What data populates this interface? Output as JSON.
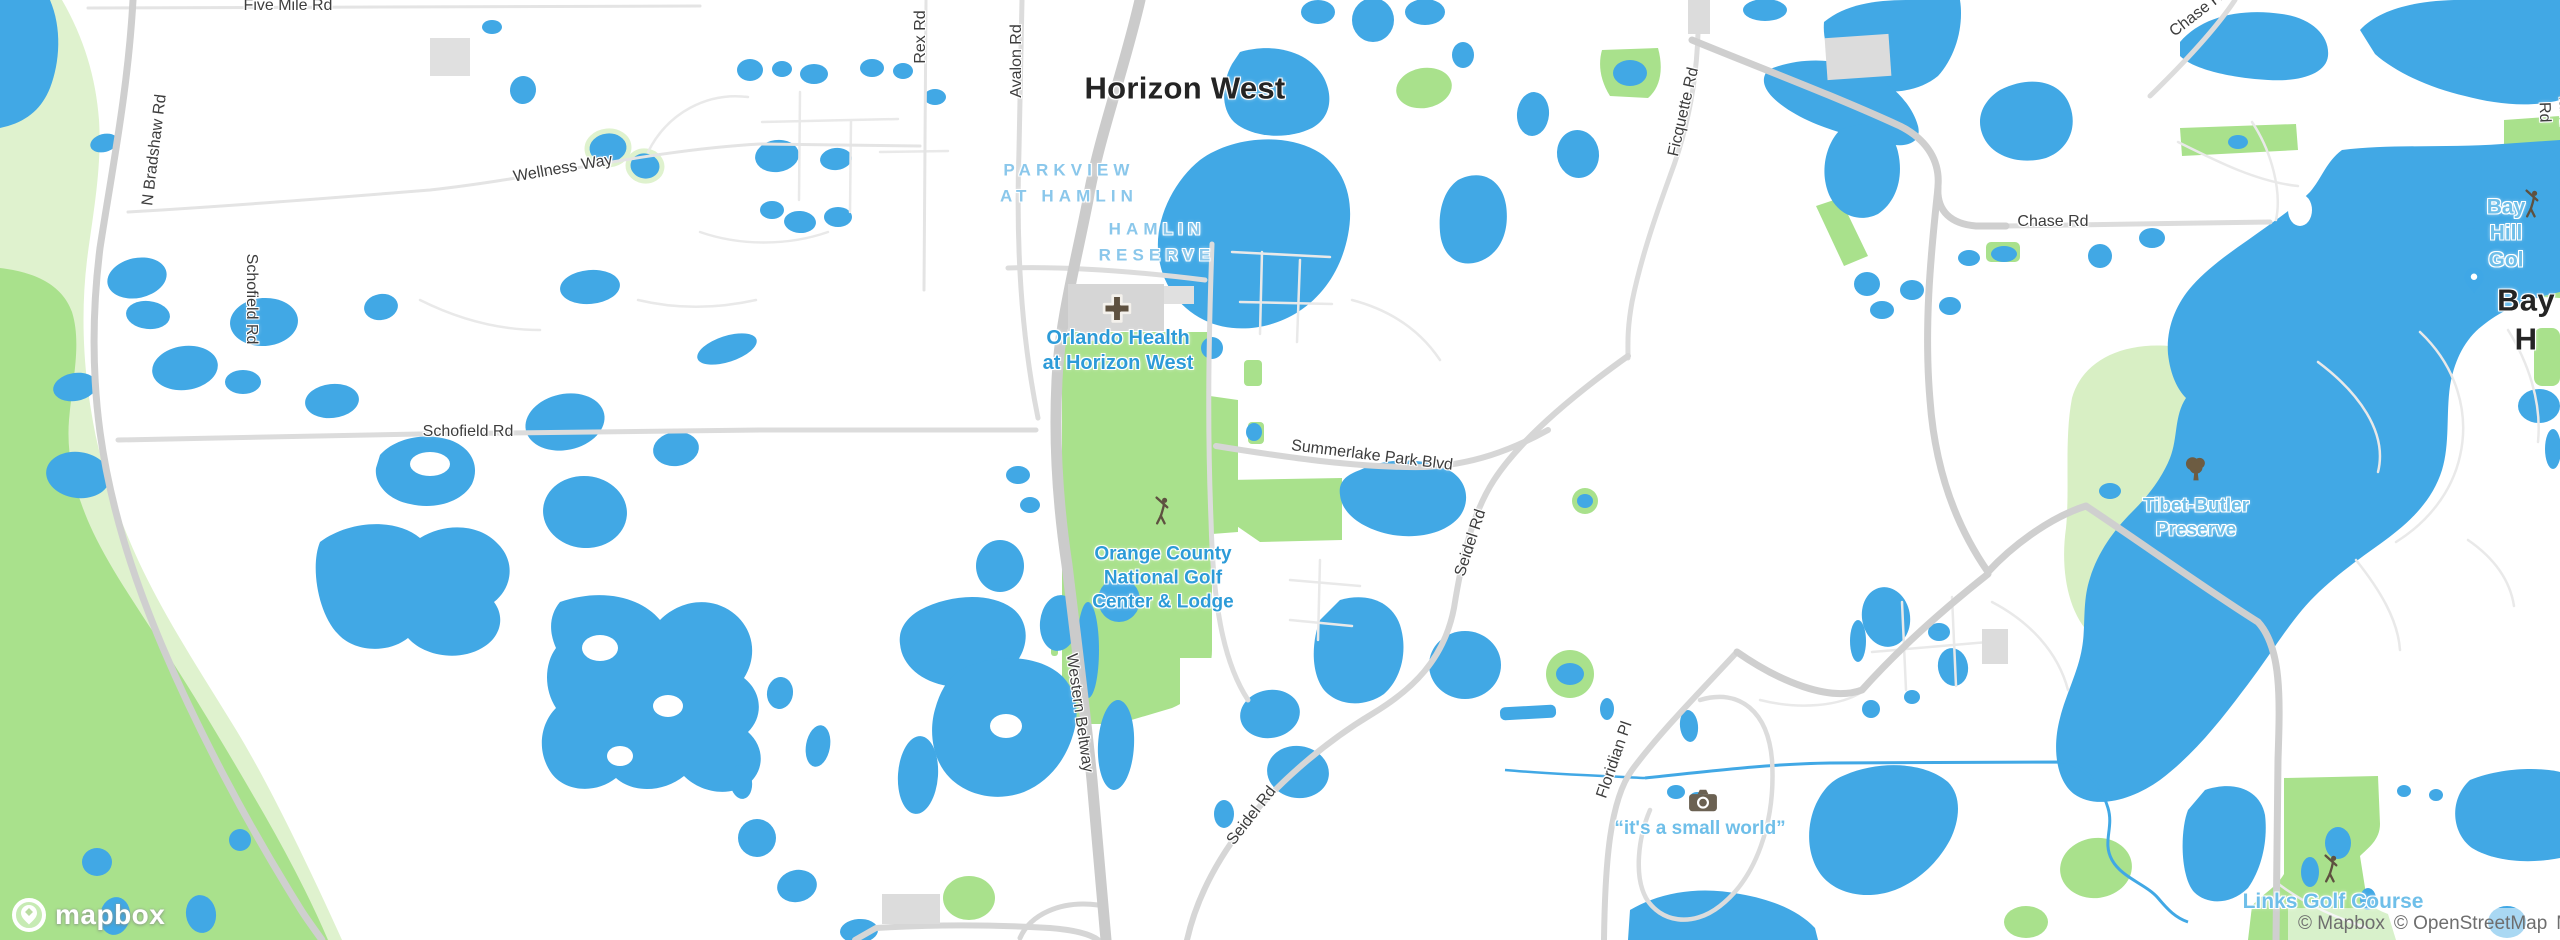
{
  "map_type": "mapbox-street-map",
  "region": "Horizon West, Orange County, Florida",
  "colors": {
    "water": "#41A8E5",
    "green_bright": "#A9E18C",
    "green_pale": "#DFF2CE",
    "green_preserve": "#D8EFC4",
    "road_major": "#CFCFCF",
    "road_minor": "#E9E9E9",
    "building": "#D9D9D9",
    "city_label": "#242424",
    "area_label": "#8AC7EB",
    "poi_label_blue": "#2D9BD8",
    "poi_label_light": "#6FBFE9",
    "road_label": "#3D3D3D",
    "icon_brown": "#5E5140",
    "pin_blue": "#3FA7E6"
  },
  "icons": {
    "hospital-cross-icon": "brown rounded cross on hospital building",
    "golf-course-icon": "brown golfer silhouette (3 instances)",
    "park-tree-icon": "brown tree",
    "camera-icon": "brown camera badge (attraction)",
    "location-pin-icon": "blue teardrop map pin",
    "mapbox-pin-icon": "white circle badge with pin and star"
  },
  "labels": [
    {
      "id": "horizon-west",
      "text": "Horizon West"
    },
    {
      "id": "bay-hill-city",
      "text": "Bay H"
    },
    {
      "id": "parkview-at-hamlin",
      "text": "PARKVIEW\nAT HAMLIN"
    },
    {
      "id": "hamlin-reserve",
      "text": "HAMLIN\nRESERVE"
    },
    {
      "id": "orlando-health",
      "text": "Orlando Health\nat Horizon West"
    },
    {
      "id": "orange-county-golf",
      "text": "Orange County\nNational Golf\nCenter & Lodge"
    },
    {
      "id": "small-world",
      "text": "“it's a small world”"
    },
    {
      "id": "tibet-butler",
      "text": "Tibet-Butler\nPreserve"
    },
    {
      "id": "links-golf",
      "text": "Links Golf Course"
    },
    {
      "id": "bay-hill-golf",
      "text": "Bay Hill Gol"
    },
    {
      "id": "five-mile-rd",
      "text": "Five Mile Rd"
    },
    {
      "id": "wellness-way",
      "text": "Wellness Way"
    },
    {
      "id": "n-bradshaw-rd",
      "text": "N Bradshaw Rd"
    },
    {
      "id": "schofield-rd-v",
      "text": "Schofield Rd"
    },
    {
      "id": "schofield-rd-h",
      "text": "Schofield Rd"
    },
    {
      "id": "rex-rd",
      "text": "Rex Rd"
    },
    {
      "id": "avalon-rd",
      "text": "Avalon Rd"
    },
    {
      "id": "ficquette-rd",
      "text": "Ficquette Rd"
    },
    {
      "id": "summerlake-park-blvd",
      "text": "Summerlake Park Blvd"
    },
    {
      "id": "seidel-rd-1",
      "text": "Seidel Rd"
    },
    {
      "id": "seidel-rd-2",
      "text": "Seidel Rd"
    },
    {
      "id": "western-beltway",
      "text": "Western Beltway"
    },
    {
      "id": "floridian-pl",
      "text": "Floridian Pl"
    },
    {
      "id": "chase-rd",
      "text": "Chase Rd"
    },
    {
      "id": "chase-rd-corner",
      "text": "Chase Rd"
    },
    {
      "id": "partial-road-right-edge",
      "text": "land Rd"
    }
  ],
  "attribution": {
    "items": [
      "© Mapbox",
      "© OpenStreetMap",
      "Map"
    ]
  },
  "logo": {
    "text": "mapbox"
  }
}
